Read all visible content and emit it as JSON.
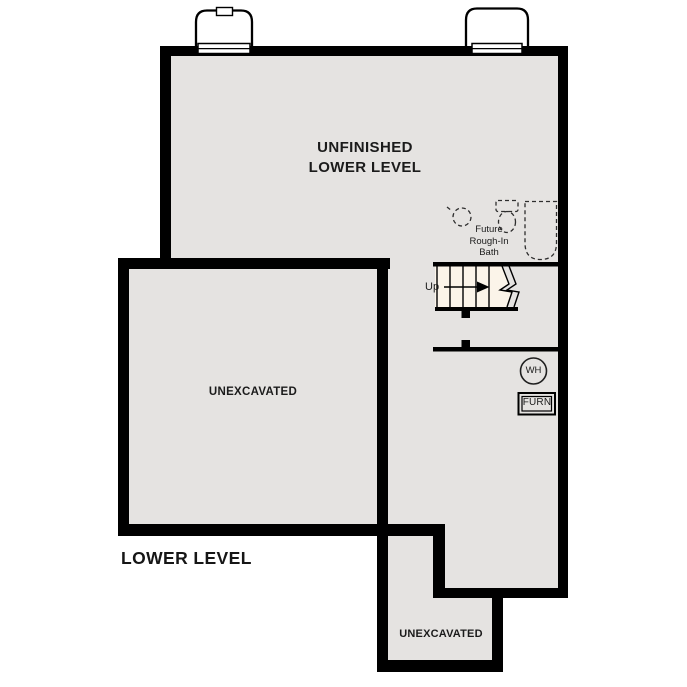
{
  "plan": {
    "title": "LOWER LEVEL",
    "rooms": {
      "main": {
        "label": "UNFINISHED\nLOWER LEVEL"
      },
      "left_unexcavated": {
        "label": "UNEXCAVATED"
      },
      "bottom_unexcavated": {
        "label": "UNEXCAVATED"
      },
      "bath": {
        "label": "Future\nRough-In\nBath"
      },
      "stairs": {
        "direction_label": "Up"
      },
      "water_heater": {
        "label": "WH"
      },
      "furnace": {
        "label": "FURN"
      }
    },
    "colors": {
      "wall": "#000000",
      "floor": "#e5e3e1",
      "stair_fill": "#fbf4e9",
      "background": "#ffffff",
      "text": "#1b1b1b"
    }
  }
}
